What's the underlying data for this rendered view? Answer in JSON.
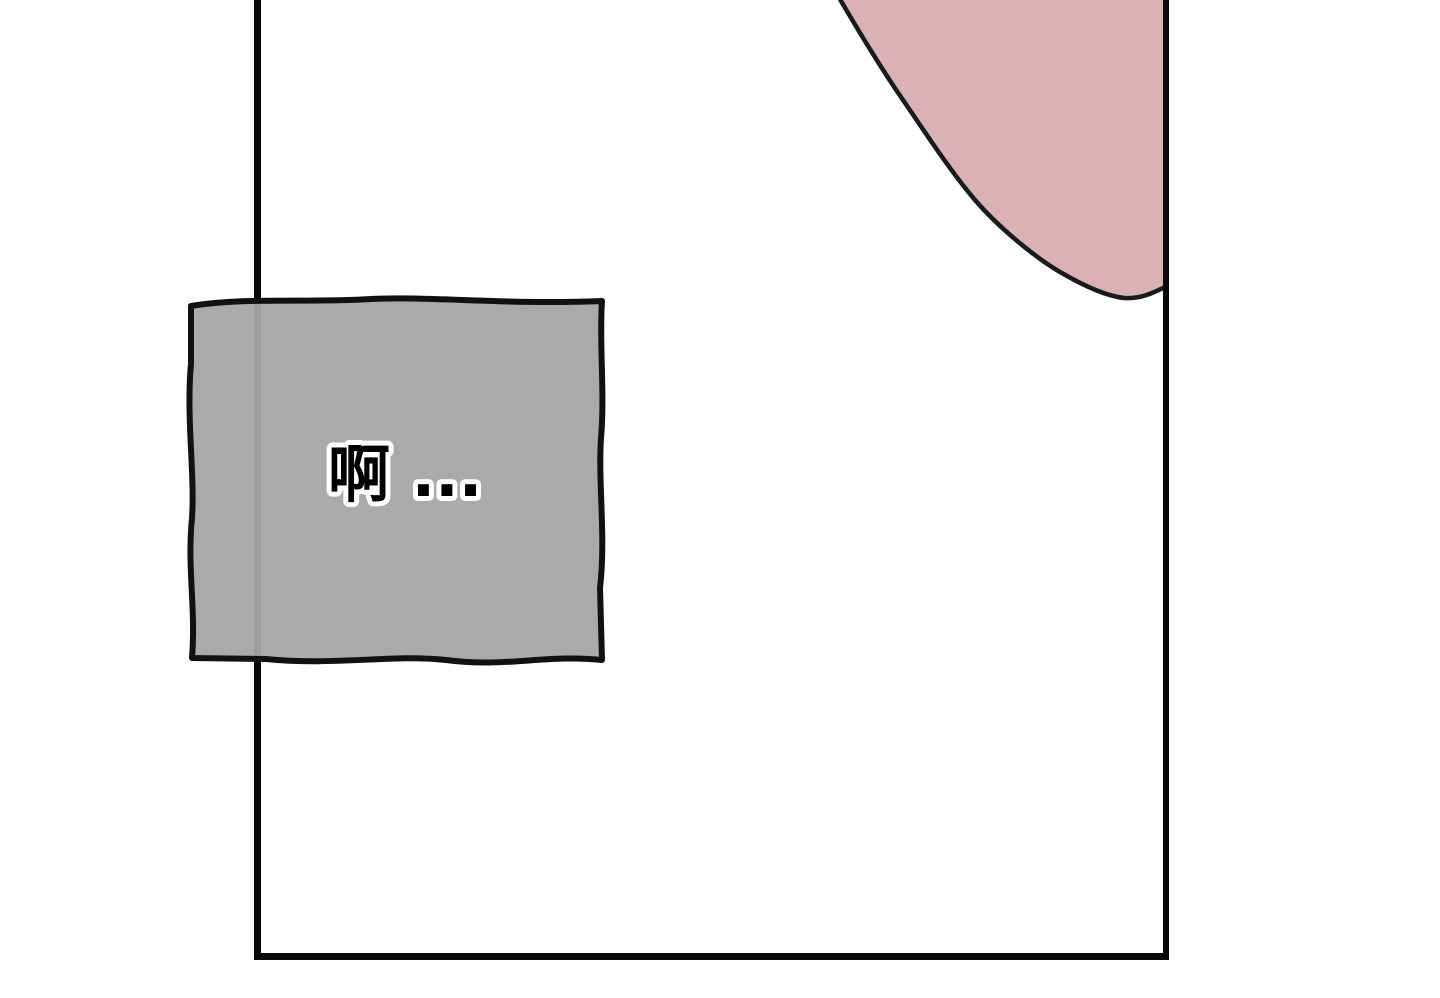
{
  "page": {
    "background_color": "#ffffff"
  },
  "panel": {
    "background_color": "#ffffff",
    "border_color": "#0a0a0a"
  },
  "body_shape": {
    "description": "skin-shape",
    "fill_color": "#dab1b4",
    "outline_color": "#1a1a1a"
  },
  "speech_box": {
    "text": "啊 ...",
    "fill_color": "#a5a5a5",
    "border_color": "#111111",
    "text_color": "#000000",
    "text_outline_color": "#ffffff"
  }
}
